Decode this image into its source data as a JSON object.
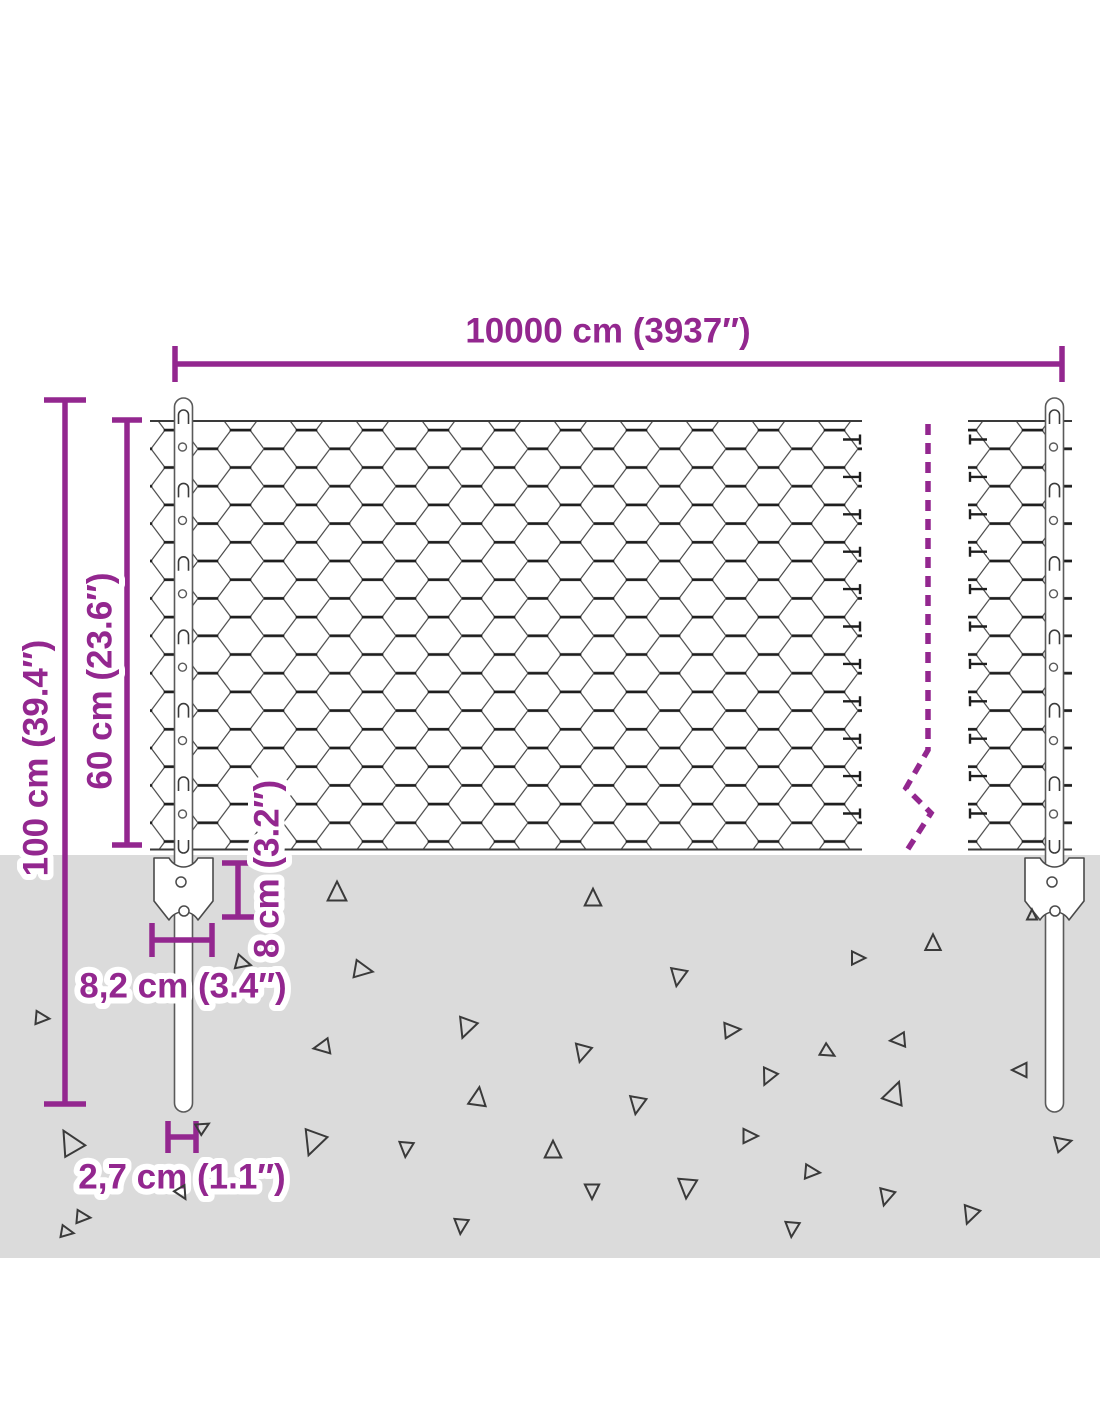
{
  "diagram": {
    "type": "product-dimension-diagram",
    "subject": "chain-link wire mesh fence with posts and ground anchors",
    "labels": {
      "total_width": "10000 cm (3937″)",
      "total_height": "100 cm (39.4″)",
      "mesh_height": "60 cm (23.6″)",
      "anchor_depth": "8 cm (3.2″)",
      "anchor_plate_width": "8,2 cm (3.4″)",
      "post_diameter": "2,7 cm (1.1″)"
    },
    "colors": {
      "dimension_accent": "#93278F",
      "ground": "#DBDBDB",
      "wire": "#4A4A4A",
      "wire_twist": "#1E1E1E",
      "triangle_outline": "#3A3A3A",
      "post_outline": "#5A5A5A"
    }
  },
  "decor": {
    "triangles": [
      [
        337,
        892,
        17,
        0
      ],
      [
        593,
        898,
        15,
        0
      ],
      [
        243,
        963,
        13,
        105
      ],
      [
        363,
        970,
        16,
        100
      ],
      [
        678,
        977,
        15,
        190
      ],
      [
        42,
        1018,
        12,
        95
      ],
      [
        466,
        1028,
        17,
        200
      ],
      [
        732,
        1030,
        14,
        85
      ],
      [
        322,
        1047,
        14,
        260
      ],
      [
        582,
        1053,
        15,
        195
      ],
      [
        768,
        1077,
        14,
        205
      ],
      [
        478,
        1097,
        16,
        8
      ],
      [
        637,
        1105,
        15,
        190
      ],
      [
        70,
        1142,
        21,
        330
      ],
      [
        313,
        1143,
        21,
        200
      ],
      [
        406,
        1149,
        13,
        185
      ],
      [
        553,
        1150,
        15,
        0
      ],
      [
        750,
        1136,
        13,
        90
      ],
      [
        203,
        1127,
        11,
        60
      ],
      [
        182,
        1193,
        11,
        150
      ],
      [
        83,
        1217,
        12,
        95
      ],
      [
        933,
        943,
        14,
        0
      ],
      [
        858,
        958,
        12,
        90
      ],
      [
        898,
        1040,
        13,
        265
      ],
      [
        828,
        1052,
        12,
        120
      ],
      [
        1020,
        1070,
        13,
        270
      ],
      [
        895,
        1093,
        19,
        20
      ],
      [
        1063,
        1143,
        14,
        75
      ],
      [
        812,
        1172,
        13,
        95
      ],
      [
        886,
        1197,
        14,
        195
      ],
      [
        970,
        1215,
        15,
        200
      ],
      [
        792,
        1229,
        13,
        185
      ],
      [
        1032,
        915,
        9,
        0
      ],
      [
        592,
        1191,
        13,
        180
      ],
      [
        687,
        1188,
        17,
        185
      ],
      [
        461,
        1226,
        13,
        185
      ],
      [
        67,
        1232,
        11,
        100
      ]
    ],
    "stub_rows": {
      "start": 439.5,
      "step": 37.4,
      "count": 11
    },
    "post_centers": [
      183.5,
      1054.5
    ]
  }
}
